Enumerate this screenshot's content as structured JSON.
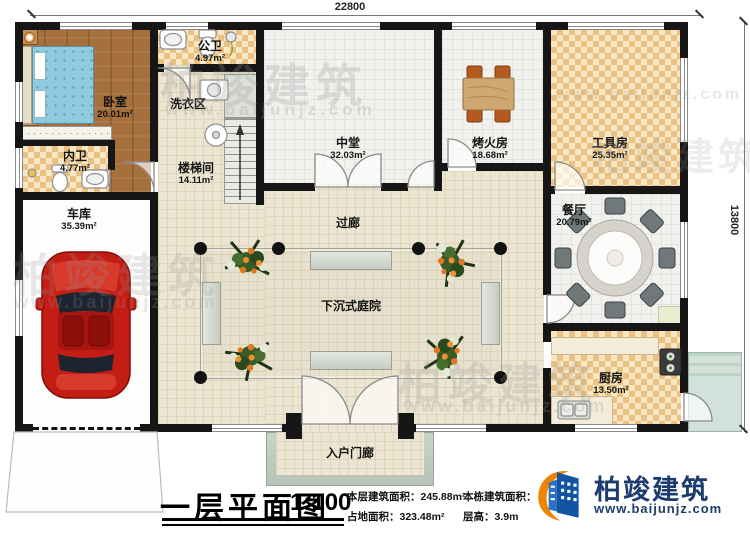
{
  "dimensions": {
    "top": "22800",
    "right": "13800"
  },
  "rooms": [
    {
      "label": "卧室",
      "area": "20.01m²"
    },
    {
      "label": "内卫",
      "area": "4.77m²"
    },
    {
      "label": "公卫",
      "area": "4.97m²"
    },
    {
      "label": "洗衣区",
      "area": ""
    },
    {
      "label": "楼梯间",
      "area": "14.11m²"
    },
    {
      "label": "车库",
      "area": "35.39m²"
    },
    {
      "label": "中堂",
      "area": "32.03m²"
    },
    {
      "label": "烤火房",
      "area": "18.68m²"
    },
    {
      "label": "工具房",
      "area": "25.35m²"
    },
    {
      "label": "餐厅",
      "area": "20.79m²"
    },
    {
      "label": "厨房",
      "area": "13.50m²"
    },
    {
      "label": "过廊",
      "area": ""
    },
    {
      "label": "下沉式庭院",
      "area": ""
    },
    {
      "label": "入户门廊",
      "area": ""
    }
  ],
  "title_block": {
    "title": "一层平面图",
    "scale": "1:100",
    "stats": [
      {
        "label": "本层建筑面积：",
        "value": "245.88m²"
      },
      {
        "label": "占地面积：",
        "value": "323.48m²"
      },
      {
        "label": "本栋建筑面积：",
        "value": ""
      },
      {
        "label": "层高：",
        "value": "3.9m"
      }
    ]
  },
  "branding": {
    "company": "柏竣建筑",
    "website": "www.baijunjz.com"
  },
  "watermark": {
    "text": "柏竣建筑",
    "url": "www.baijunjz.com"
  },
  "colors": {
    "wall": "#161616",
    "floor_beige": "#ebe5d1",
    "tile_light": "#f8e7c3",
    "tile_dark": "#eac182",
    "wood": "#a5703c",
    "gray_room": "#f1f1ee",
    "deck": "#cfe0d8",
    "car": "#c41e14",
    "logo_blue": "#1454a4",
    "logo_orange": "#f08300",
    "brand_text": "#1c3c6e"
  }
}
